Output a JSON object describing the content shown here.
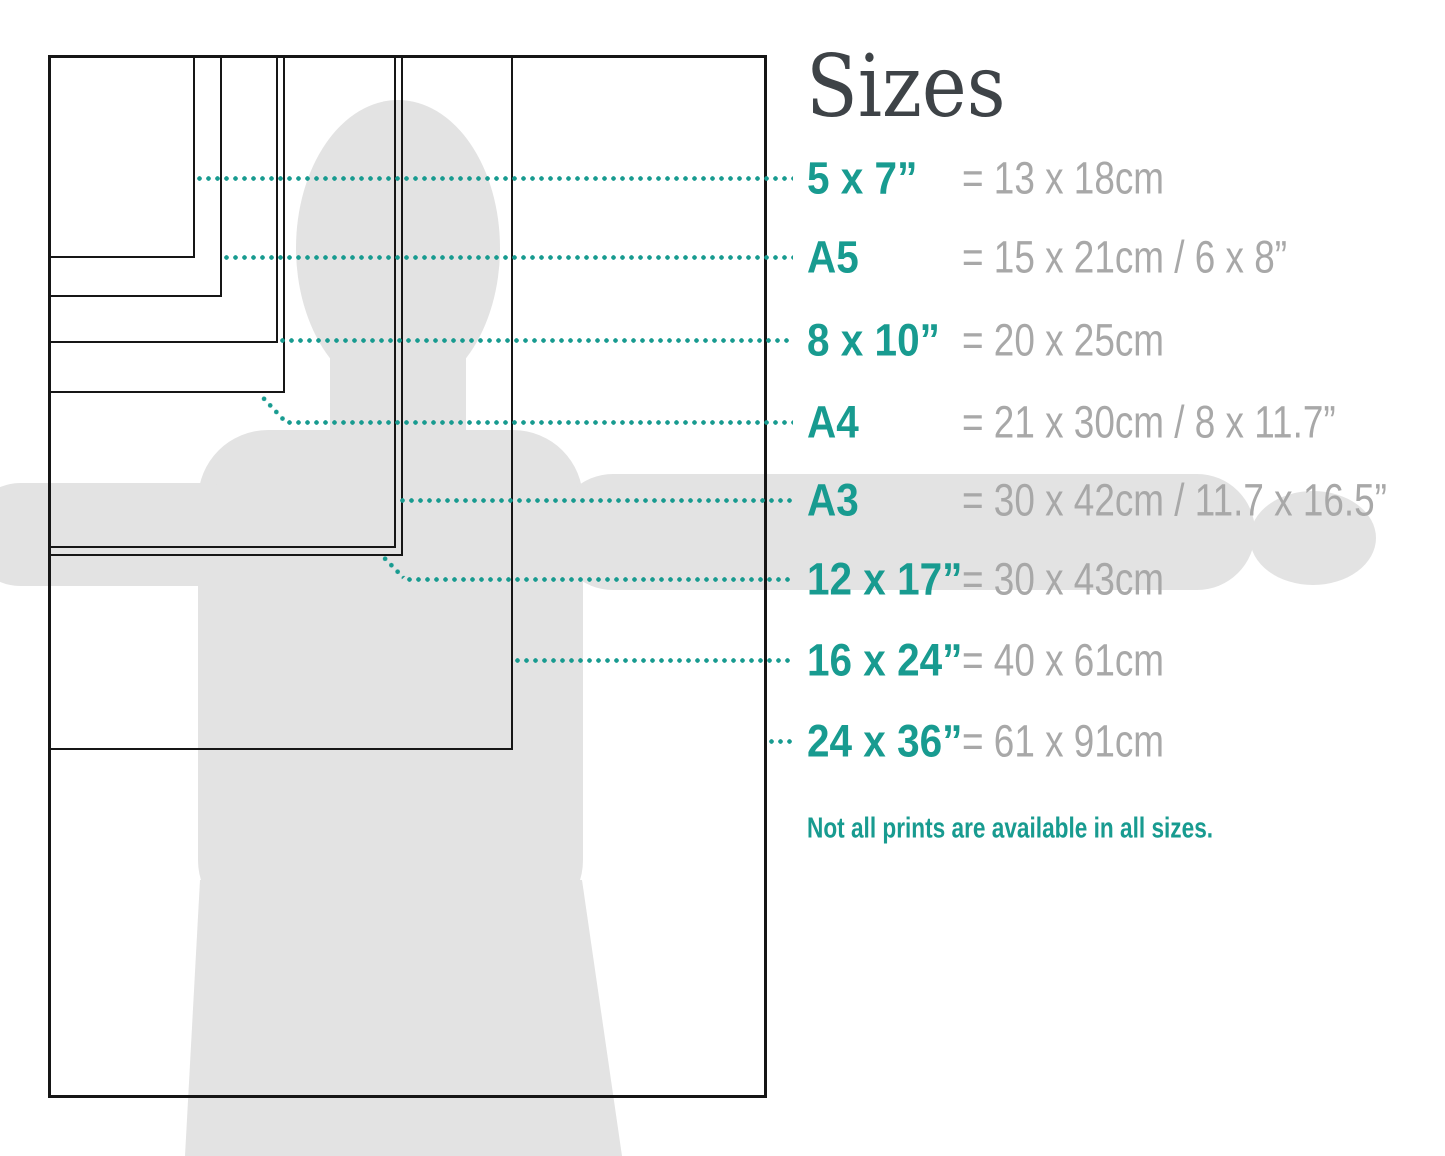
{
  "title": "Sizes",
  "note": "Not all prints are available in all sizes.",
  "colors": {
    "teal": "#189b90",
    "gray_text": "#a8a8a8",
    "title_text": "#3e4347",
    "rect_line": "#161616",
    "silhouette": "#e3e3e3"
  },
  "sizes": [
    {
      "id": "5x7",
      "label": "5 x 7”",
      "metric": "= 13 x 18cm",
      "rect": {
        "w": 147,
        "h": 203
      },
      "row_y": 178,
      "lead_from": 195,
      "elbow": null
    },
    {
      "id": "a5",
      "label": "A5",
      "metric": "= 15 x 21cm / 6 x 8”",
      "rect": {
        "w": 174,
        "h": 242
      },
      "row_y": 257,
      "lead_from": 222,
      "elbow": null
    },
    {
      "id": "8x10",
      "label": "8 x 10”",
      "metric": "= 20 x 25cm",
      "rect": {
        "w": 230,
        "h": 288
      },
      "row_y": 340,
      "lead_from": 278,
      "elbow": null
    },
    {
      "id": "a4",
      "label": "A4",
      "metric": "= 21 x 30cm / 8 x 11.7”",
      "rect": {
        "w": 237,
        "h": 338
      },
      "row_y": 422,
      "lead_from": 285,
      "elbow": {
        "x": 261,
        "y": 395,
        "angle": 47,
        "len": 34
      }
    },
    {
      "id": "a3",
      "label": "A3",
      "metric": "= 30 x 42cm / 11.7 x 16.5”",
      "rect": {
        "w": 348,
        "h": 493
      },
      "row_y": 500,
      "lead_from": 398,
      "elbow": null
    },
    {
      "id": "12x17",
      "label": "12 x 17”",
      "metric": "= 30 x 43cm",
      "rect": {
        "w": 355,
        "h": 501
      },
      "row_y": 579,
      "lead_from": 405,
      "elbow": {
        "x": 382,
        "y": 555,
        "angle": 46,
        "len": 31
      }
    },
    {
      "id": "16x24",
      "label": "16 x 24”",
      "metric": "= 40 x 61cm",
      "rect": {
        "w": 465,
        "h": 695
      },
      "row_y": 660,
      "lead_from": 513,
      "elbow": null
    },
    {
      "id": "24x36",
      "label": "24 x 36”",
      "metric": "= 61 x 91cm",
      "rect": {
        "w": 719,
        "h": 1043
      },
      "row_y": 741,
      "lead_from": 767,
      "elbow": null
    }
  ],
  "leader_end_x": 793
}
